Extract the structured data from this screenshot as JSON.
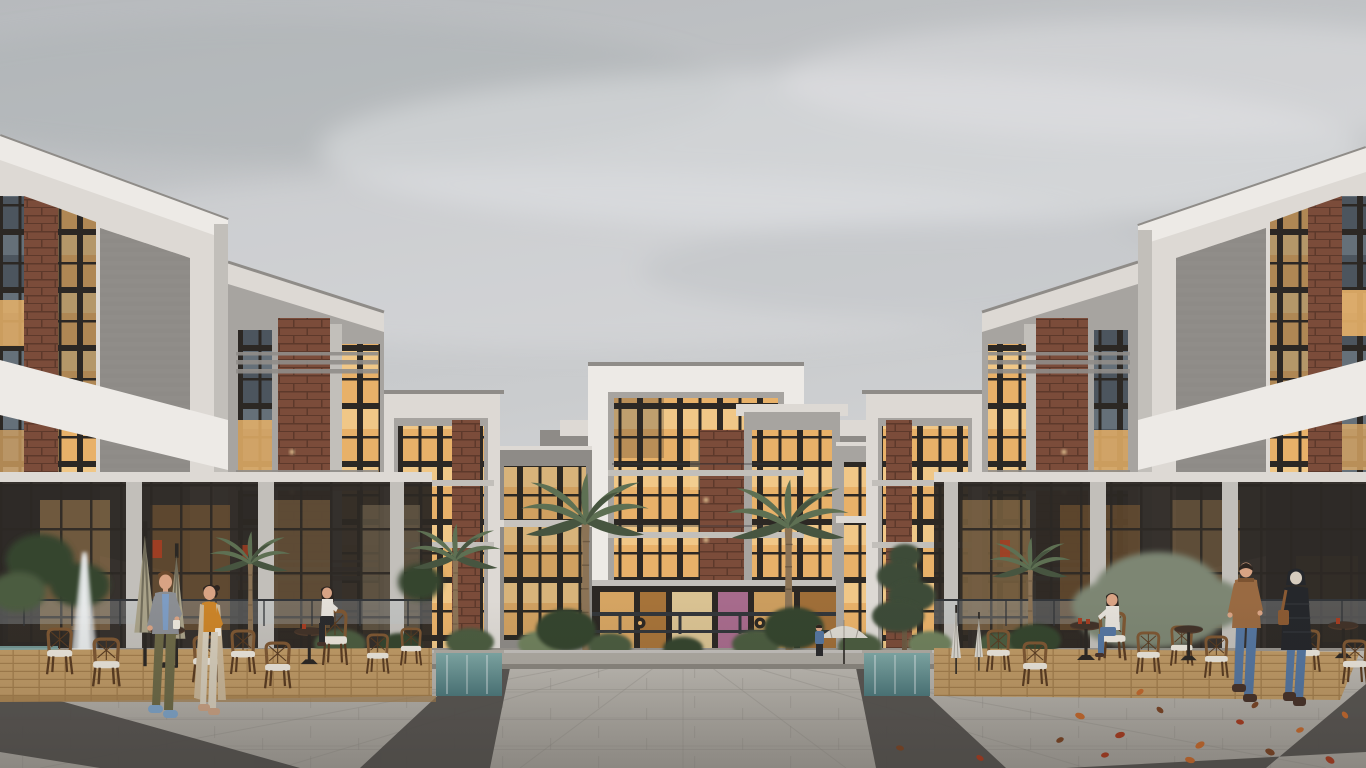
{
  "scene": {
    "title": "Modern residential compound courtyard at dusk — architectural rendering",
    "description": "Photorealistic 3D exterior visualization of a U-shaped modern apartment complex under an overcast gray sky. White, gray-concrete and brick volumes with warm lit windows surround a landscaped courtyard plaza with palm trees, planters, water features, outdoor cafe terraces with rattan chairs and umbrellas, and people walking across a paved plaza with dark diagonal granite bands and scattered autumn leaves.",
    "time_of_day": "overcast dusk",
    "elements": [
      {
        "name": "sky",
        "label": "Overcast gray cloudy sky"
      },
      {
        "name": "building-left-front",
        "label": "Left foreground apartment block, white frame with brick strip and slatted screen"
      },
      {
        "name": "building-left-mid",
        "label": "Left mid apartment block, gray concrete with brick panel and slat balconies"
      },
      {
        "name": "building-left-inner",
        "label": "Left inner courtyard block with warm lit windows"
      },
      {
        "name": "building-center",
        "label": "Central apartment tower, white frame, glass facade, brick inset, lit ground-floor lobby"
      },
      {
        "name": "building-right-inner",
        "label": "Right inner courtyard block with warm lit windows"
      },
      {
        "name": "building-right-mid",
        "label": "Right mid apartment block, gray concrete with brick panel"
      },
      {
        "name": "building-right-front",
        "label": "Right foreground apartment block, white frame with slatted screen and brick strip"
      },
      {
        "name": "palm-trees",
        "label": "Tall palm trees flanking the central building"
      },
      {
        "name": "cafe-terrace-left",
        "label": "Outdoor cafe terrace with rattan bistro chairs, pedestal tables and closed khaki umbrellas"
      },
      {
        "name": "cafe-terrace-right",
        "label": "Outdoor cafe terrace with rattan bistro chairs, tables with red cups and white umbrellas"
      },
      {
        "name": "fountain",
        "label": "White plaza fountain jet at far left"
      },
      {
        "name": "water-features",
        "label": "Teal cascading water walls and reflecting pools beside planters"
      },
      {
        "name": "plaza",
        "label": "Foreground paved plaza with light pavers and dark diagonal granite bands"
      },
      {
        "name": "autumn-leaves",
        "label": "Orange and red leaves scattered on the right pavement"
      }
    ],
    "people": {
      "walking_couple_left": "Man in gray blazer, blue shirt, olive trousers and light-blue sneakers holding a coffee cup, walking beside a woman in an orange shirt, long beige cardigan and cream trousers",
      "walking_couple_right": "Couple seen from behind — man in brown leather jacket and blue jeans, woman in black puffer jacket with light hood, jeans and brown shoulder bag",
      "seated_woman_left": "Woman in white top and black trousers seated on a tall rattan chair at a cafe table",
      "seated_woman_right": "Woman with long dark hair in white sweater and blue jeans seated at a round cafe table with red cups",
      "child_by_pool": "Small figure in a blue jacket standing near the right pool"
    }
  },
  "colors": {
    "sky_top": "#b7babd",
    "sky_mid": "#c9cbcd",
    "sky_light": "#dadbdc",
    "cloud": "#e2e3e5",
    "cloud_shadow": "#a7abb0",
    "white_hi": "#edeae6",
    "white": "#ddd9d4",
    "white_shade": "#c2bfba",
    "roofcap": "#8f8c88",
    "concrete": "#a7a4a0",
    "concrete_dark": "#8e8b87",
    "concrete_darker": "#767370",
    "frame": "#2c2824",
    "brick": "#7b4c3a",
    "brick_dark": "#5d392b",
    "warm": "#e8b169",
    "warm_hi": "#f8dda6",
    "warm_deep": "#c5863f",
    "cool": "#4c555e",
    "cool_hi": "#76828b",
    "slat": "#908d89",
    "railing": "#33363a",
    "glassrail": "#b9c6cb",
    "foliage": "#4b5b40",
    "foliage_dark": "#36442d",
    "foliage_light": "#6f815d",
    "pine": "#3d4b37",
    "treegray": "#7d8673",
    "palm": "#5e7053",
    "palm_dark": "#475540",
    "trunk": "#8b7356",
    "trunk_dark": "#6d5942",
    "deck": "#bf9a66",
    "deck_dark": "#a37e4d",
    "rattan": "#7d5733",
    "rattan_dark": "#5a3c22",
    "cushion": "#eae5db",
    "tabletop": "#4f3a2c",
    "umb_khaki": "#a9a289",
    "umb_white": "#dbd8d0",
    "pave_hi": "#c2beb7",
    "pave": "#b2aea7",
    "pave_low": "#a29e97",
    "pave_dark": "#514e4b",
    "pave_joint": "#87837d",
    "stone": "#aeaaa2",
    "water": "#7fa8a6",
    "water_deep": "#4d797c",
    "skin": "#d8a384",
    "hair_dark": "#2d2520",
    "hair_brown": "#6b4a2e",
    "beanie": "#d6ccbe",
    "blazer": "#8b8e93",
    "shirt_blue": "#7d9cc3",
    "pants_olive": "#6d6947",
    "shoe_blue": "#7ea3c7",
    "top_orange": "#cb8428",
    "cardigan": "#c9b698",
    "pants_cream": "#d5ccba",
    "shoe_tan": "#c9a183",
    "jacket_leather": "#996a42",
    "leather_dark": "#7c5331",
    "jeans": "#5576a0",
    "puffer": "#25272b",
    "quilt": "#3b3e44",
    "bag": "#8a5a33",
    "shoe_dark": "#48332a",
    "sweater": "#e4e0d9",
    "pants_black": "#2b2b2d",
    "leaf_orange": "#c2692e",
    "leaf_red": "#a53d22",
    "leaf_brown": "#7a4526",
    "fountain": "#ebeeef",
    "glow_pink": "#c77ca6",
    "accessory_yellow": "#d9a829"
  }
}
